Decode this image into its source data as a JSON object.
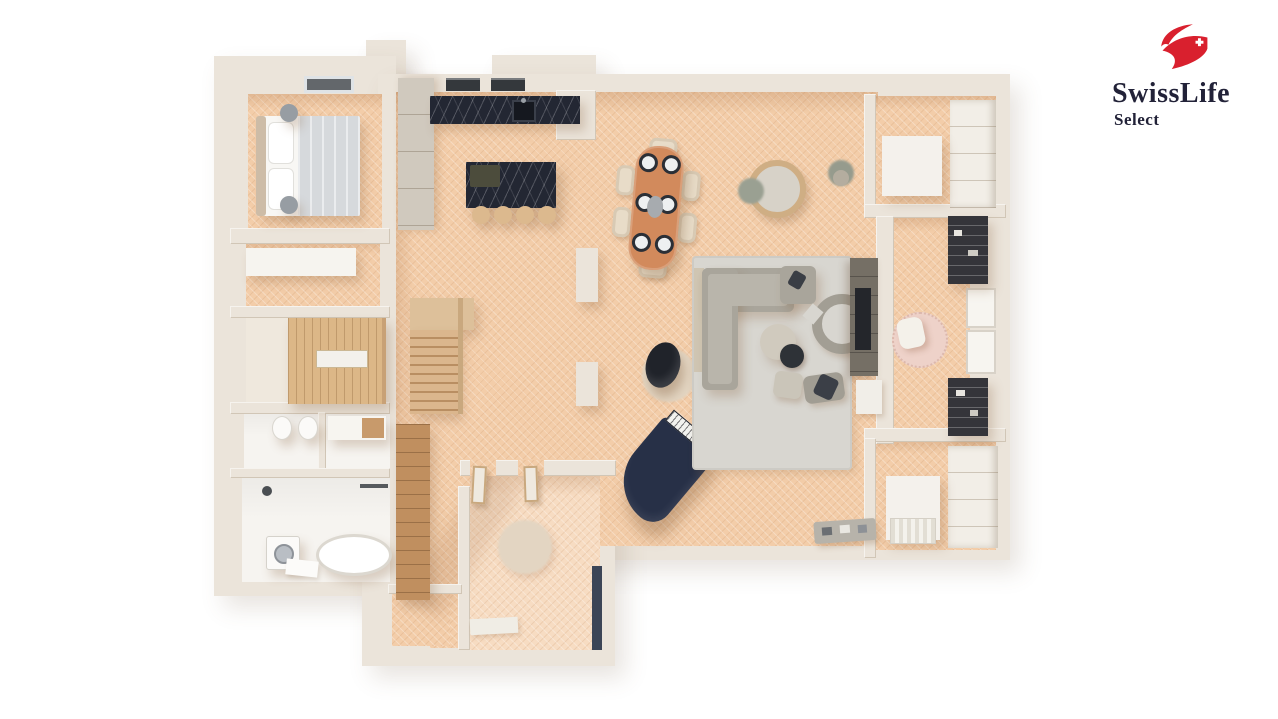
{
  "logo": {
    "brand": "SwissLife",
    "sub": "Select"
  },
  "colors": {
    "background": "#ffffff",
    "wall": "#ebe4da",
    "wall_shade": "#d8cfc1",
    "floor": "#f3cda9",
    "floor_light": "#f7dcc2",
    "tile": "#f6f4f0",
    "rug": "#d8d6d0",
    "sofa": "#a9a59b",
    "sofa_light": "#b9b5ab",
    "wood_table": "#d28a5c",
    "chair_beige": "#e8dcc8",
    "stool_tan": "#dcb98e",
    "stair_wood": "#dbb68d",
    "sauna_wood": "#dcb787",
    "closet_wood": "#c08f5f",
    "marble": "#232733",
    "piano_navy": "#273047",
    "egg_chair": "#20232a",
    "tv_unit": "#756f65",
    "shelf_dark": "#35353a",
    "pink_rug": "#eed2c9",
    "entry_rug": "#e3d5c2",
    "door_navy": "#3c4556",
    "logo_red": "#d9202e",
    "logo_text": "#222238"
  }
}
